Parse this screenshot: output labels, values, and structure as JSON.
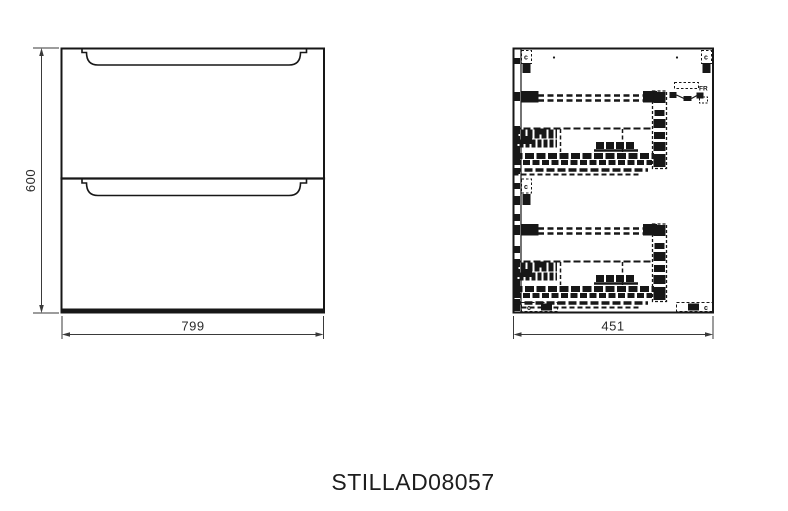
{
  "drawing": {
    "product_code": "STILLAD08057",
    "front_view": {
      "height_label": "600",
      "width_label": "799"
    },
    "side_view": {
      "depth_label": "451",
      "bracket_label": "c",
      "hinge_label": "FR"
    },
    "colors": {
      "line": "#171717",
      "dimension": "#3a3a3a",
      "background": "#ffffff"
    }
  }
}
